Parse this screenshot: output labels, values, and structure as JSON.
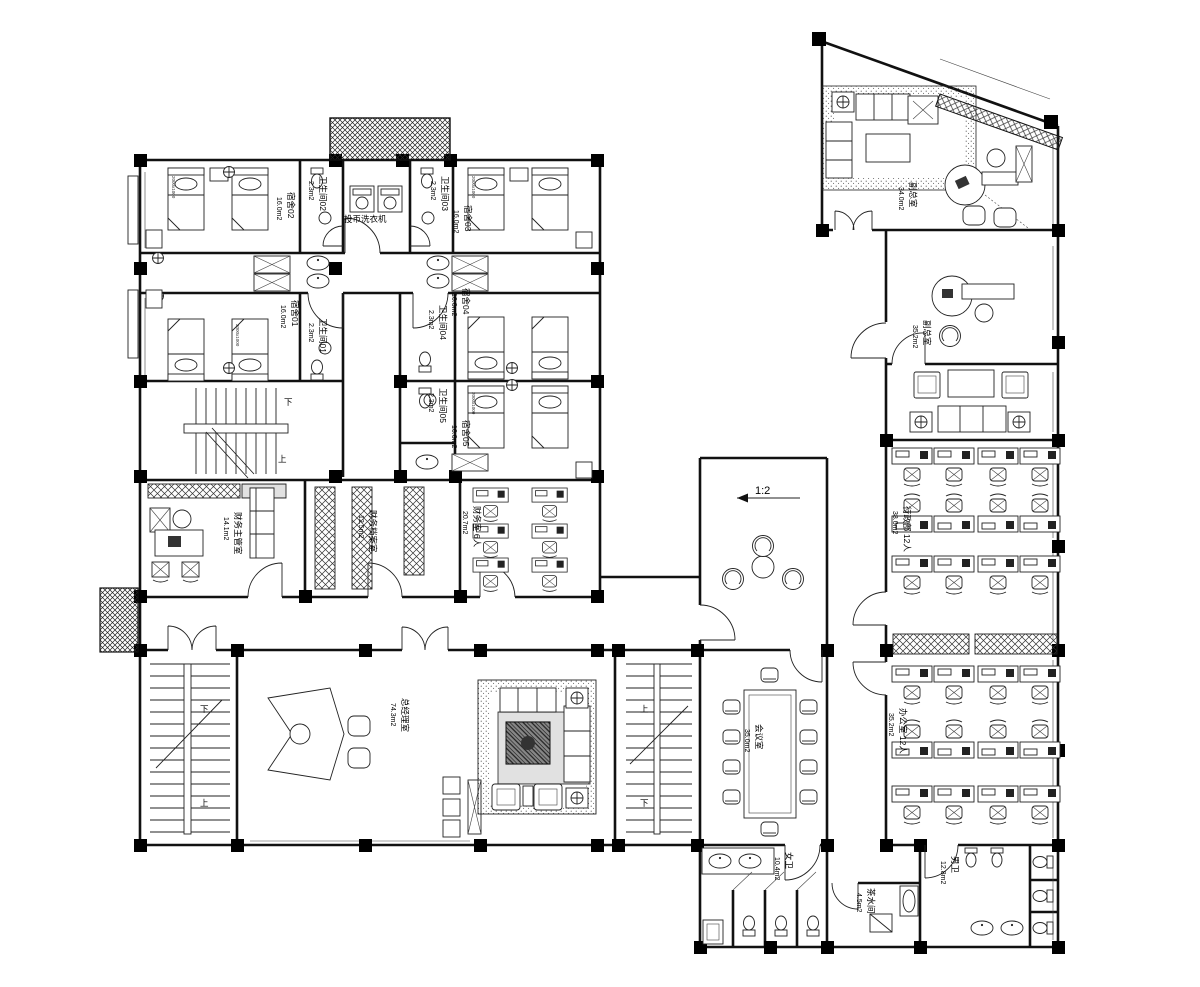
{
  "drawing": {
    "type": "floor-plan"
  },
  "rooms": {
    "dorm01": {
      "name": "宿舍01",
      "area": "16.0m2"
    },
    "dorm02": {
      "name": "宿舍02",
      "area": "16.0m2"
    },
    "dorm03": {
      "name": "宿舍03",
      "area": "16.0m2"
    },
    "dorm04": {
      "name": "宿舍04",
      "area": "16.0m2"
    },
    "dorm05": {
      "name": "宿舍05",
      "area": "16.0m2"
    },
    "wc01": {
      "name": "卫生间01",
      "area": "2.3m2"
    },
    "wc02": {
      "name": "卫生间02",
      "area": "2.3m2"
    },
    "wc03": {
      "name": "卫生间03",
      "area": "2.3m2"
    },
    "wc04": {
      "name": "卫生间04",
      "area": "2.3m2"
    },
    "wc05": {
      "name": "卫生间05",
      "area": "2.3m2"
    },
    "laundry": {
      "name": "投币洗衣机"
    },
    "finance_manager": {
      "name": "财务主管室",
      "area": "14.1m2"
    },
    "finance_archive": {
      "name": "财务档案室",
      "area": "12.5m2"
    },
    "finance_office": {
      "name": "财务室 6人",
      "area": "20.7m2"
    },
    "gm_office": {
      "name": "总经理室",
      "area": "74.3m2"
    },
    "vice_gm_top": {
      "name": "副总室",
      "area": "34.0m2"
    },
    "vice_gm_mid": {
      "name": "副总室",
      "area": "35.2m2"
    },
    "admin_dept": {
      "name": "行政部 12人",
      "area": "38.0m2"
    },
    "office_12": {
      "name": "办公室 12人",
      "area": "35.2m2"
    },
    "meeting": {
      "name": "会议室",
      "area": "35.0m2"
    },
    "wc_female": {
      "name": "女卫",
      "area": "10.4m2"
    },
    "wc_male": {
      "name": "男卫",
      "area": "12.8m2"
    },
    "pantry": {
      "name": "茶水间",
      "area": "4.5m2"
    }
  },
  "annotations": {
    "up": "上",
    "down": "下",
    "slope": "1:2",
    "bed_size": "2000x1000"
  },
  "colors": {
    "line": "#111111",
    "background": "#ffffff"
  }
}
